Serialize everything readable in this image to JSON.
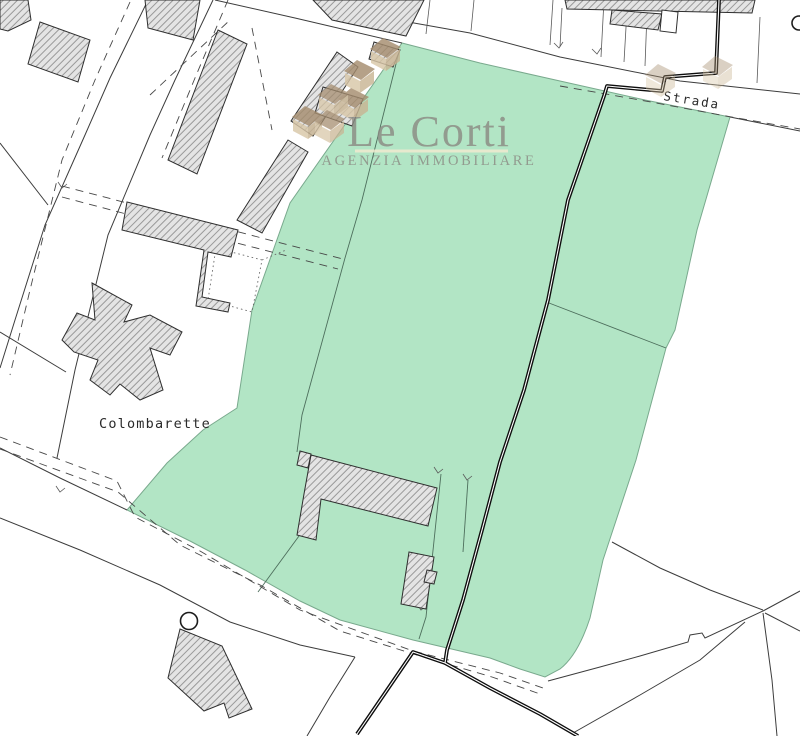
{
  "map": {
    "road_label": "Strada",
    "locality_label": "Colombarette"
  },
  "logo": {
    "title": "Le Corti",
    "subtitle": "AGENZIA IMMOBILIARE"
  },
  "colors": {
    "parcel_fill": "#b2e5c5",
    "parcel_edge": "#79a98d",
    "map_line": "#3c3c3c",
    "boundary": "#0d0d0d",
    "building_fill": "#e4e4e4",
    "building_hatch": "#999999",
    "logo_text": "#8b8b84",
    "logo_divider": "#f3ead0",
    "house_roof": "#a58d6f",
    "house_wall": "#d9c7a8",
    "background": "#ffffff"
  }
}
